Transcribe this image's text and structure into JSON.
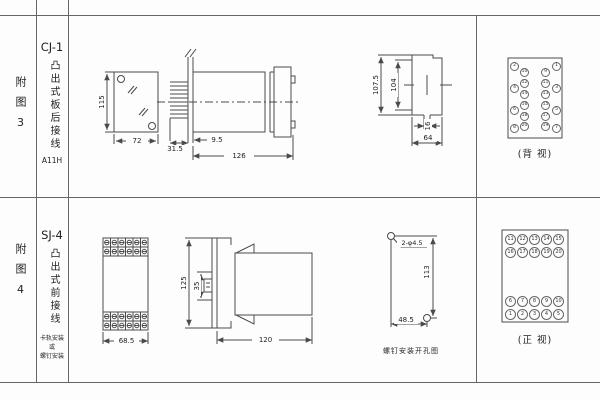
{
  "fig3": {
    "row_label": "附图3",
    "model": "CJ-1",
    "type_label": "凸出式板后接线",
    "code": "A11H",
    "front": {
      "dim_height": "115",
      "dim_width": "72"
    },
    "side": {
      "dim_pins": "31.5",
      "dim_offset": "9.5",
      "dim_length": "126"
    },
    "cutout": {
      "dim_outer": "107.5",
      "dim_inner": "104",
      "dim_tab": "16",
      "dim_width": "64"
    },
    "rear": {
      "caption": "(背 视)",
      "left_outer": [
        "2",
        "4",
        "6",
        "8"
      ],
      "left_inner": [
        "10",
        "12",
        "14",
        "16",
        "18",
        "20"
      ],
      "right_inner": [
        "9",
        "11",
        "13",
        "15",
        "17",
        "19"
      ],
      "right_outer": [
        "1",
        "3",
        "5",
        "7"
      ]
    }
  },
  "fig4": {
    "row_label": "附图4",
    "model": "SJ-4",
    "type_label": "凸出式前接线",
    "mount_line1": "卡轨安装",
    "mount_line2": "或",
    "mount_line3": "螺钉安装",
    "front": {
      "dim_width": "68.5"
    },
    "side": {
      "dim_height": "125",
      "dim_rail": "35",
      "dim_depth": "120"
    },
    "drill": {
      "holes": "2-φ4.5",
      "dim_v": "113",
      "dim_h": "48.5",
      "caption": "螺钉安装开孔图"
    },
    "frontview": {
      "caption": "(正 视)",
      "row1": [
        "11",
        "12",
        "13",
        "14",
        "15"
      ],
      "row2": [
        "16",
        "17",
        "18",
        "19",
        "20"
      ],
      "row3": [
        "6",
        "7",
        "8",
        "9",
        "10"
      ],
      "row4": [
        "1",
        "2",
        "3",
        "4",
        "5"
      ]
    }
  }
}
